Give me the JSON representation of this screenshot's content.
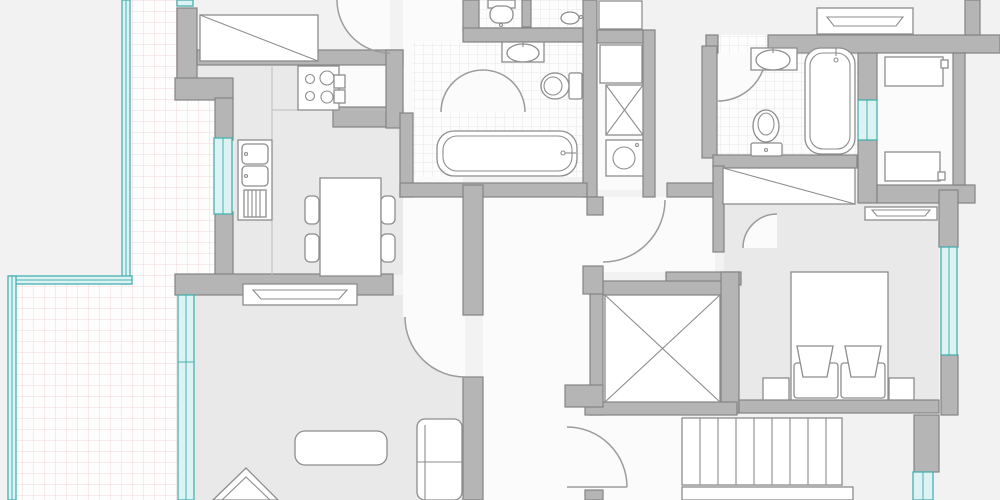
{
  "title": "apartment-floor-plan",
  "palette": {
    "outside": "#f2f2f2",
    "room": "#e9e9e9",
    "wall": "#b5b5b5",
    "wallline": "#848484",
    "window_teal": "#49b0b0",
    "window_fill": "#ddf3f3",
    "furniture_outline": "#8d8d8d",
    "terrace_grid": "#eed8d8",
    "tile_grid": "#e7e7e7"
  },
  "rooms": [
    {
      "name": "terrace",
      "features": [
        "tiled-grid-floor",
        "glass-wall-teal"
      ]
    },
    {
      "name": "kitchen-dining",
      "features": [
        "stove-4-burners",
        "double-sink-unit",
        "dish-rack",
        "counter",
        "dining-table",
        "chair",
        "chair",
        "chair",
        "chair",
        "window",
        "radiator",
        "wardrobe-diagonal"
      ]
    },
    {
      "name": "wc",
      "features": [
        "toilet",
        "tiled-floor"
      ]
    },
    {
      "name": "shower-room",
      "features": [
        "floor-drain",
        "tiled-floor"
      ]
    },
    {
      "name": "bathroom-main",
      "features": [
        "washbasin",
        "toilet",
        "bathtub-horizontal",
        "tiled-floor",
        "door-swing"
      ]
    },
    {
      "name": "utility-column",
      "features": [
        "closet",
        "cabinet-crossed",
        "washing-machine"
      ]
    },
    {
      "name": "bathroom-2",
      "features": [
        "washbasin",
        "toilet",
        "bathtub-vertical",
        "tiled-floor",
        "interior-window",
        "door-swing"
      ]
    },
    {
      "name": "dressing-room",
      "features": [
        "wardrobe-diagonal",
        "door-swing"
      ]
    },
    {
      "name": "bedroom",
      "features": [
        "double-bed",
        "pillow",
        "pillow",
        "nightstand",
        "nightstand",
        "window",
        "radiator"
      ]
    },
    {
      "name": "living-room",
      "features": [
        "coffee-table",
        "armchair",
        "corner-sofa",
        "glazed-wall",
        "radiator"
      ]
    },
    {
      "name": "hallway",
      "features": [
        "entry-door-swing",
        "interior-door-swing"
      ]
    },
    {
      "name": "adjacent-room",
      "features": [
        "single-bed",
        "single-bed",
        "radiator",
        "window"
      ]
    },
    {
      "name": "stairwell",
      "features": [
        "staircase-9-treads",
        "landing",
        "elevator-shaft-crossed"
      ]
    }
  ],
  "counts": {
    "windows": 8,
    "door_swings": 7,
    "radiators": 3,
    "bathtubs": 2,
    "toilets": 3,
    "washbasins": 2
  }
}
